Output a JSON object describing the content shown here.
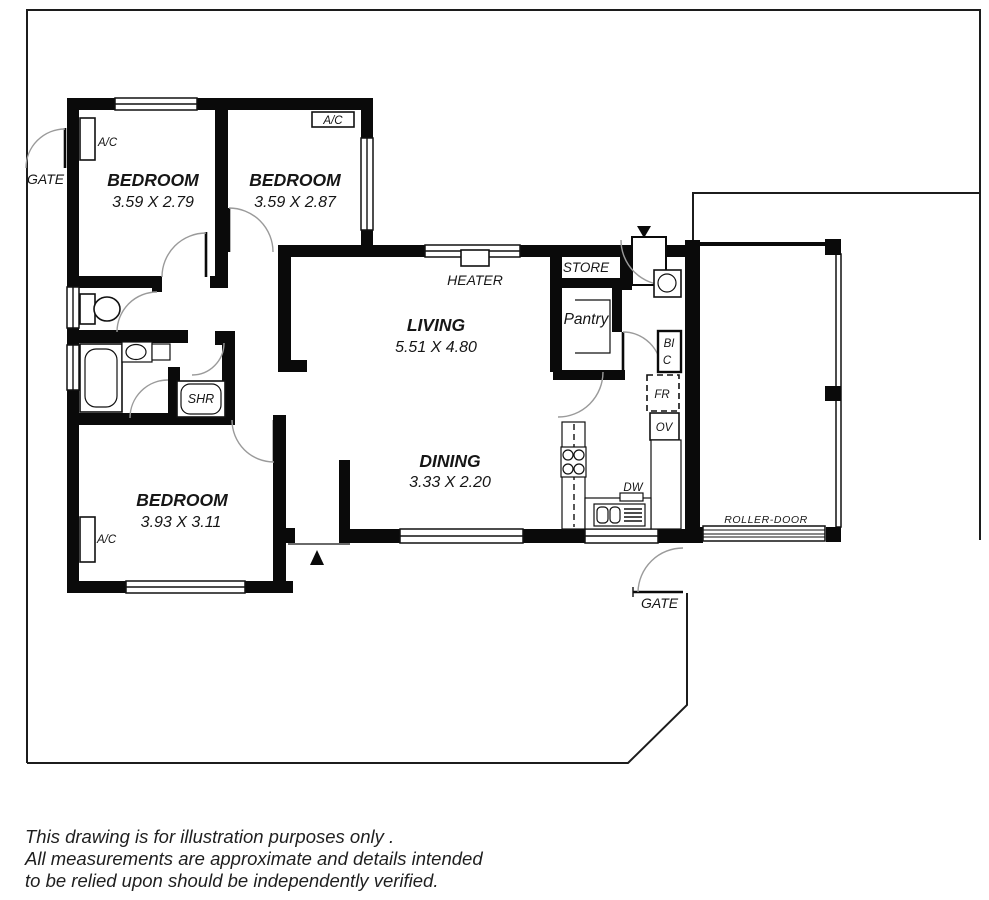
{
  "drawing": {
    "type": "residential floor plan",
    "colors": {
      "line": "#000000",
      "door_arc": "#999999",
      "background": "#ffffff"
    }
  },
  "rooms": [
    {
      "id": "bedroom-1",
      "name": "BEDROOM",
      "dims": "3.59 X 2.79"
    },
    {
      "id": "bedroom-2",
      "name": "BEDROOM",
      "dims": "3.59 X 2.87"
    },
    {
      "id": "living",
      "name": "LIVING",
      "dims": "5.51 X 4.80"
    },
    {
      "id": "dining",
      "name": "DINING",
      "dims": "3.33 X 2.20"
    },
    {
      "id": "bedroom-3",
      "name": "BEDROOM",
      "dims": "3.93 X 3.11"
    }
  ],
  "fixtures": {
    "store": "STORE",
    "pantry": "Pantry",
    "heater": "HEATER",
    "shower": "SHR",
    "cupboard_line1": "BI",
    "cupboard_line2": "C",
    "fridge": "FR",
    "oven": "OV",
    "dishwasher": "DW"
  },
  "ac_units": {
    "bedroom1": "A/C",
    "bedroom2": "A/C",
    "bedroom3": "A/C"
  },
  "garage": {
    "roller_door": "ROLLER-DOOR"
  },
  "site": {
    "gate_left": "GATE",
    "gate_bottom": "GATE"
  },
  "disclaimer": {
    "line1": "This drawing is for illustration purposes only .",
    "line2": "All measurements are approximate and details intended",
    "line3": "to be relied upon should be independently verified."
  }
}
